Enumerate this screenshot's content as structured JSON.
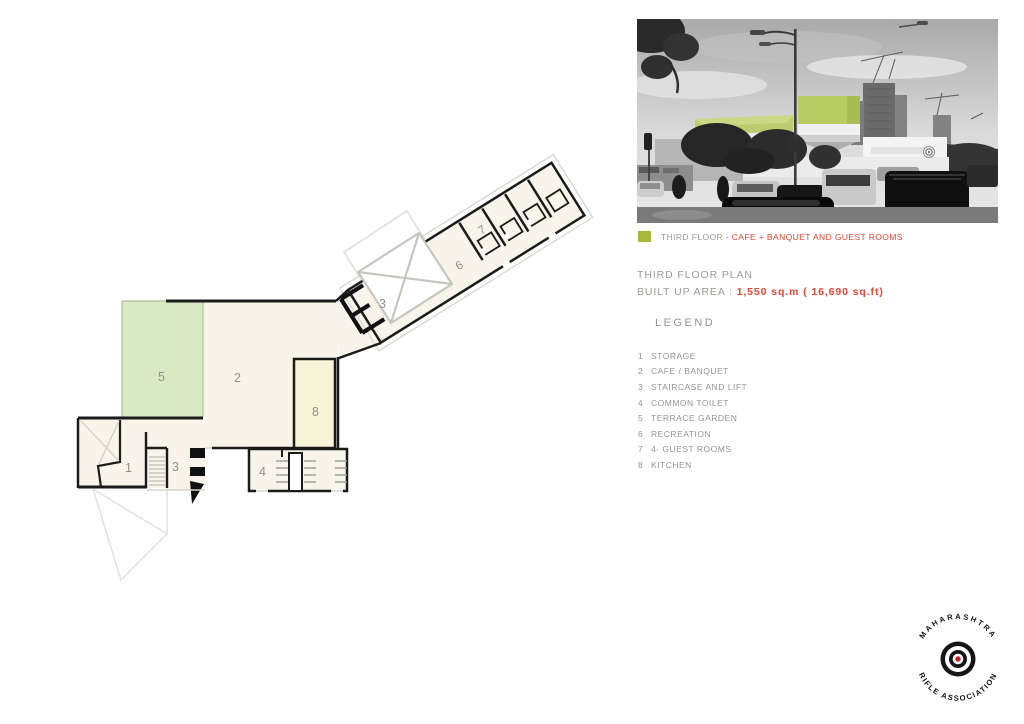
{
  "caption": {
    "floor_label": "THIRD FLOOR",
    "description": "- CAFE + BANQUET AND GUEST ROOMS",
    "swatch_color": "#a6b93a"
  },
  "title": {
    "plan_title": "THIRD FLOOR PLAN",
    "area_label": "BUILT UP AREA : ",
    "area_value": "1,550 sq.m ( 16,690 sq.ft)"
  },
  "legend": {
    "title": "LEGEND",
    "items": [
      {
        "num": "1",
        "label": "STORAGE"
      },
      {
        "num": "2",
        "label": "CAFE / BANQUET"
      },
      {
        "num": "3",
        "label": "STAIRCASE AND LIFT"
      },
      {
        "num": "4",
        "label": "COMMON TOILET"
      },
      {
        "num": "5",
        "label": "TERRACE GARDEN"
      },
      {
        "num": "6",
        "label": "RECREATION"
      },
      {
        "num": "7",
        "label": "4- GUEST ROOMS"
      },
      {
        "num": "8",
        "label": "KITCHEN"
      }
    ]
  },
  "plan": {
    "labels": [
      "5",
      "2",
      "8",
      "1",
      "3",
      "4",
      "3",
      "6",
      "7"
    ]
  },
  "logo": {
    "top_text": "MAHARASHTRA",
    "bottom_text": "RIFLE ASSOCIATION"
  },
  "colors": {
    "accent_green": "#a6b93a",
    "photo_highlight_green": "#b9cc63",
    "terrace_green": "#d9e9c3",
    "kitchen_yellow": "#f7f4d7",
    "plan_cream": "#f8f4e9",
    "red_text": "#e8432f",
    "gray_text": "#94948d"
  }
}
